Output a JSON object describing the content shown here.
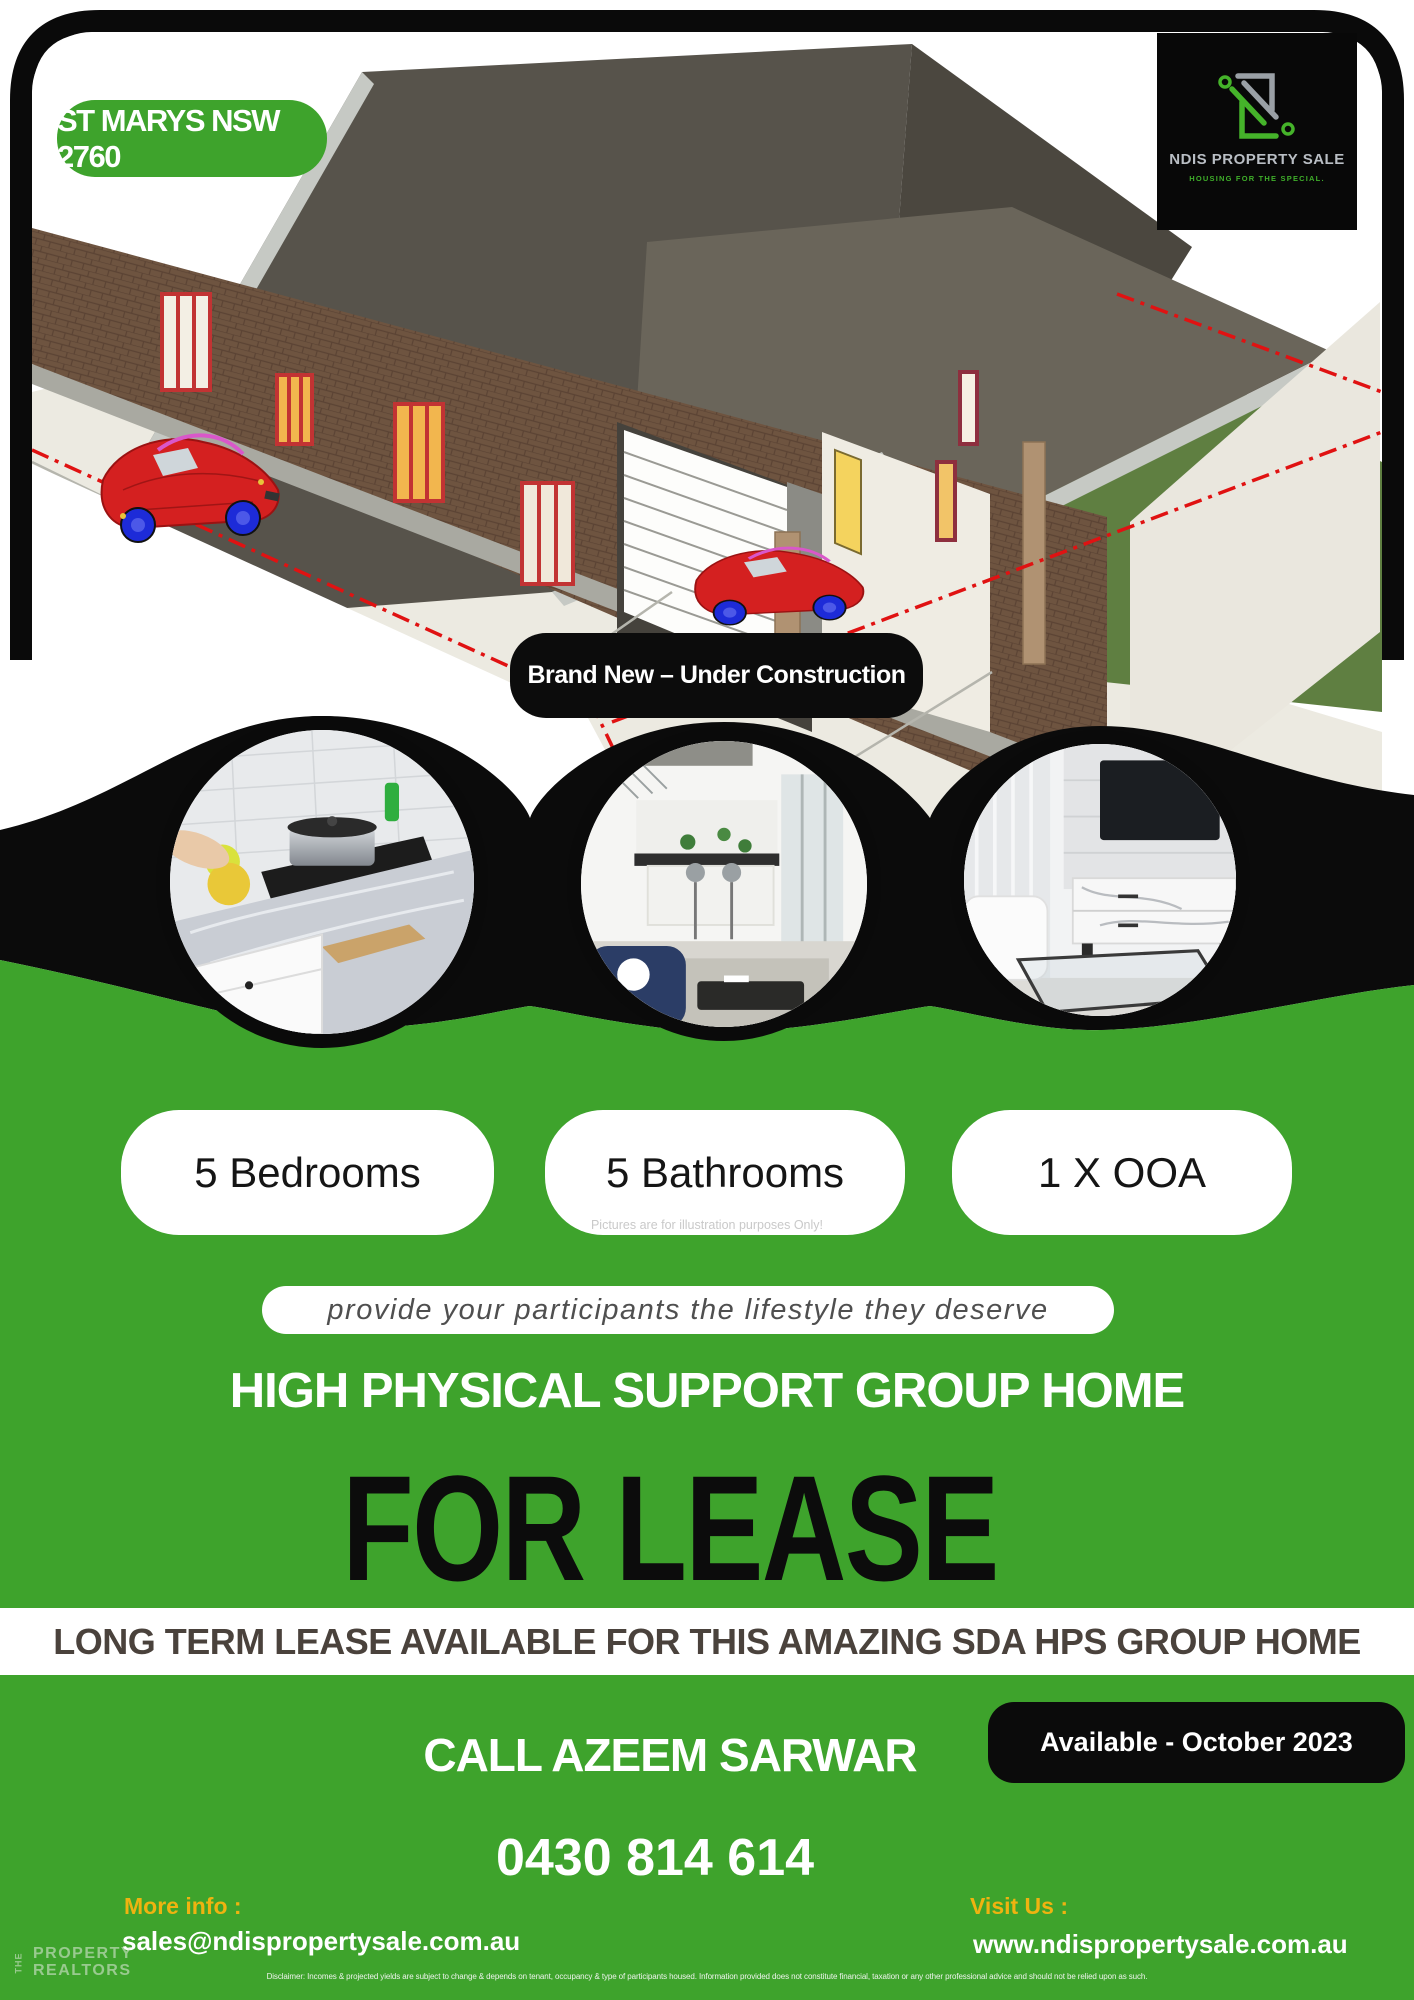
{
  "badges": {
    "location": "ST MARYS NSW 2760",
    "construction": "Brand New – Under Construction",
    "availability": "Available - October 2023"
  },
  "logo": {
    "name": "NDIS PROPERTY SALE",
    "tagline": "HOUSING FOR THE SPECIAL."
  },
  "features": [
    {
      "label": "5 Bedrooms"
    },
    {
      "label": "5 Bathrooms"
    },
    {
      "label": "1 X OOA"
    }
  ],
  "photos": {
    "caption": "Pictures are for illustration purposes Only!",
    "items": [
      {
        "name": "kitchen"
      },
      {
        "name": "open-plan-living-dining"
      },
      {
        "name": "living-room-tv-unit"
      }
    ]
  },
  "tagline_pill": "provide your participants the lifestyle they deserve",
  "headings": {
    "support": "HIGH PHYSICAL SUPPORT GROUP HOME",
    "title": "FOR LEASE",
    "subtitle": "LONG TERM LEASE AVAILABLE FOR THIS AMAZING SDA HPS GROUP HOME"
  },
  "contact": {
    "call": "CALL AZEEM SARWAR",
    "phone": "0430 814 614",
    "more_info_label": "More info :",
    "email": "sales@ndispropertysale.com.au",
    "visit_label": "Visit Us :",
    "website": "www.ndispropertysale.com.au"
  },
  "realtor": {
    "the": "THE",
    "property": "PROPERTY",
    "realtors": "REALTORS"
  },
  "disclaimer": "Disclaimer: Incomes & projected yields are subject to change & depends on tenant, occupancy & type of participants housed. Information provided does not constitute financial, taxation or any other professional advice and should not be relied upon as such.",
  "colors": {
    "green": "#3EA32C",
    "black": "#0B0B0B",
    "yellow": "#EFB310",
    "band_text": "#4A423C"
  }
}
